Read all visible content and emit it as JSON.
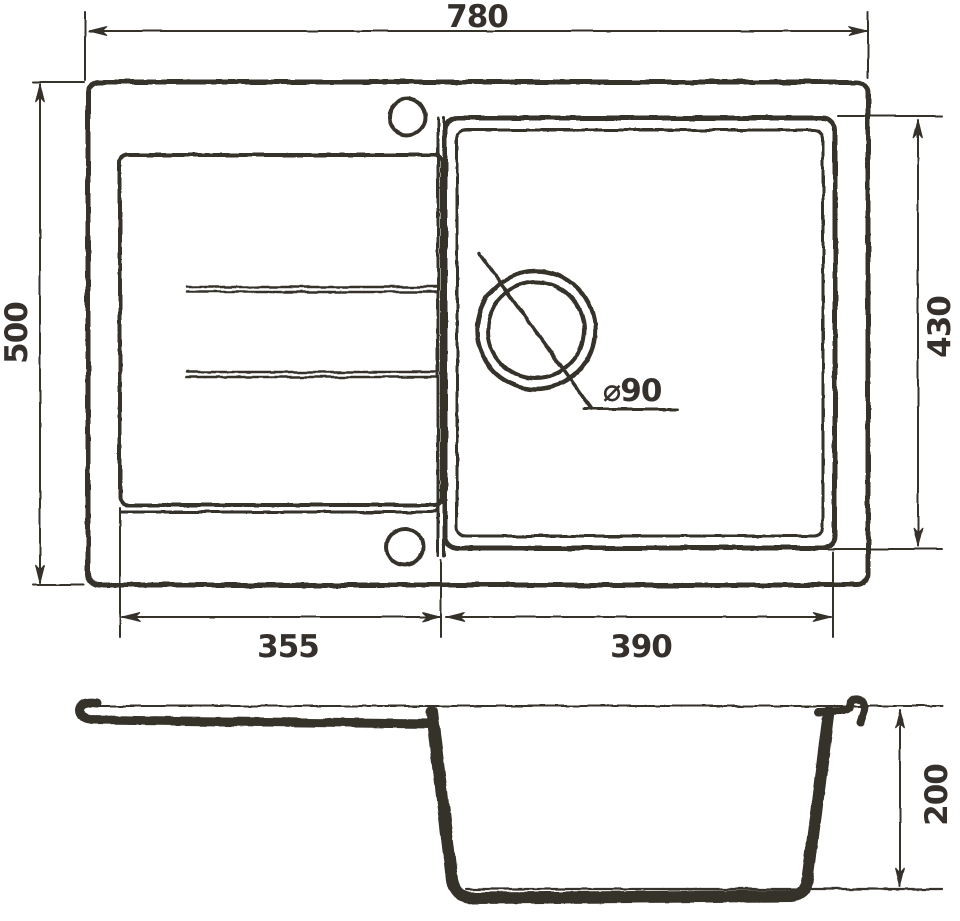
{
  "drawing": {
    "background_color": "#ffffff",
    "line_color": "#35302c",
    "views": {
      "top_view": {
        "name": "sink top view"
      },
      "section_view": {
        "name": "sink side section view"
      }
    },
    "labels": {
      "overall_width": "780",
      "overall_depth": "500",
      "drainboard_width": "355",
      "bowl_width": "390",
      "bowl_length": "430",
      "drain_diameter": "⌀90",
      "bowl_depth": "200"
    }
  }
}
